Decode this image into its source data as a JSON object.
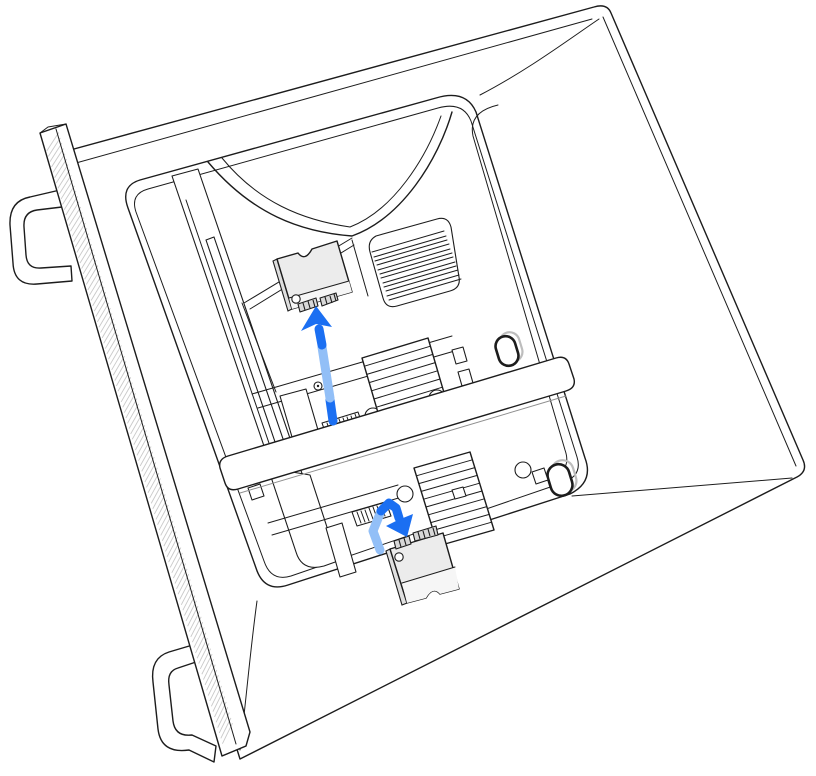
{
  "illustration": {
    "description": "Line-art illustration of a Mac Pro tower lying on its side with its housing removed. In the upper SSD bay an SSD module is lifted out with a blue arrow pointing up away from its connector; in the lower bay a second SSD module sits beside its connector with a bent blue arrow pointing down toward the slot, indicating installation.",
    "components": {
      "case": "Mac Pro enclosure shown on its side",
      "front-panel": "lattice front panel with hatched texture",
      "top-handle": "front handle (upper)",
      "bottom-handle": "front handle (lower, resting foot)",
      "vent-grille": "internal vent grille",
      "fan-shroud": "fan shroud funnel at top of bay",
      "heatsink-upper": "finned heatsink in upper SSD bay",
      "heatsink-lower": "finned heatsink in lower SSD bay",
      "ssd-connector-upper": "upper SSD board connector",
      "ssd-connector-lower": "lower SSD board connector",
      "ssd-module-upper": "SSD module removed from upper bay",
      "ssd-module-lower": "SSD module being installed in lower bay",
      "oval-slot-upper": "oval latch slot (upper)",
      "oval-slot-lower": "oval latch slot (lower)",
      "cover-bar": "memory bay cover bar"
    },
    "arrows": [
      {
        "id": "removal-arrow",
        "direction": "up",
        "meaning": "lift SSD module out of upper connector"
      },
      {
        "id": "insertion-arrow",
        "direction": "down-right",
        "meaning": "seat SSD module into lower connector"
      }
    ]
  },
  "colors": {
    "bg": "#ffffff",
    "line": "#1c1c1c",
    "line-soft": "#8f8f8f",
    "hatch": "#c9c9c9",
    "module-fill": "#ececec",
    "module-fill-light": "#f6f6f6",
    "tab-fill": "#d8d8d8",
    "arrow-dark": "#1b6ff2",
    "arrow-light": "#92bff7",
    "ghost": "#bdbdbd"
  }
}
